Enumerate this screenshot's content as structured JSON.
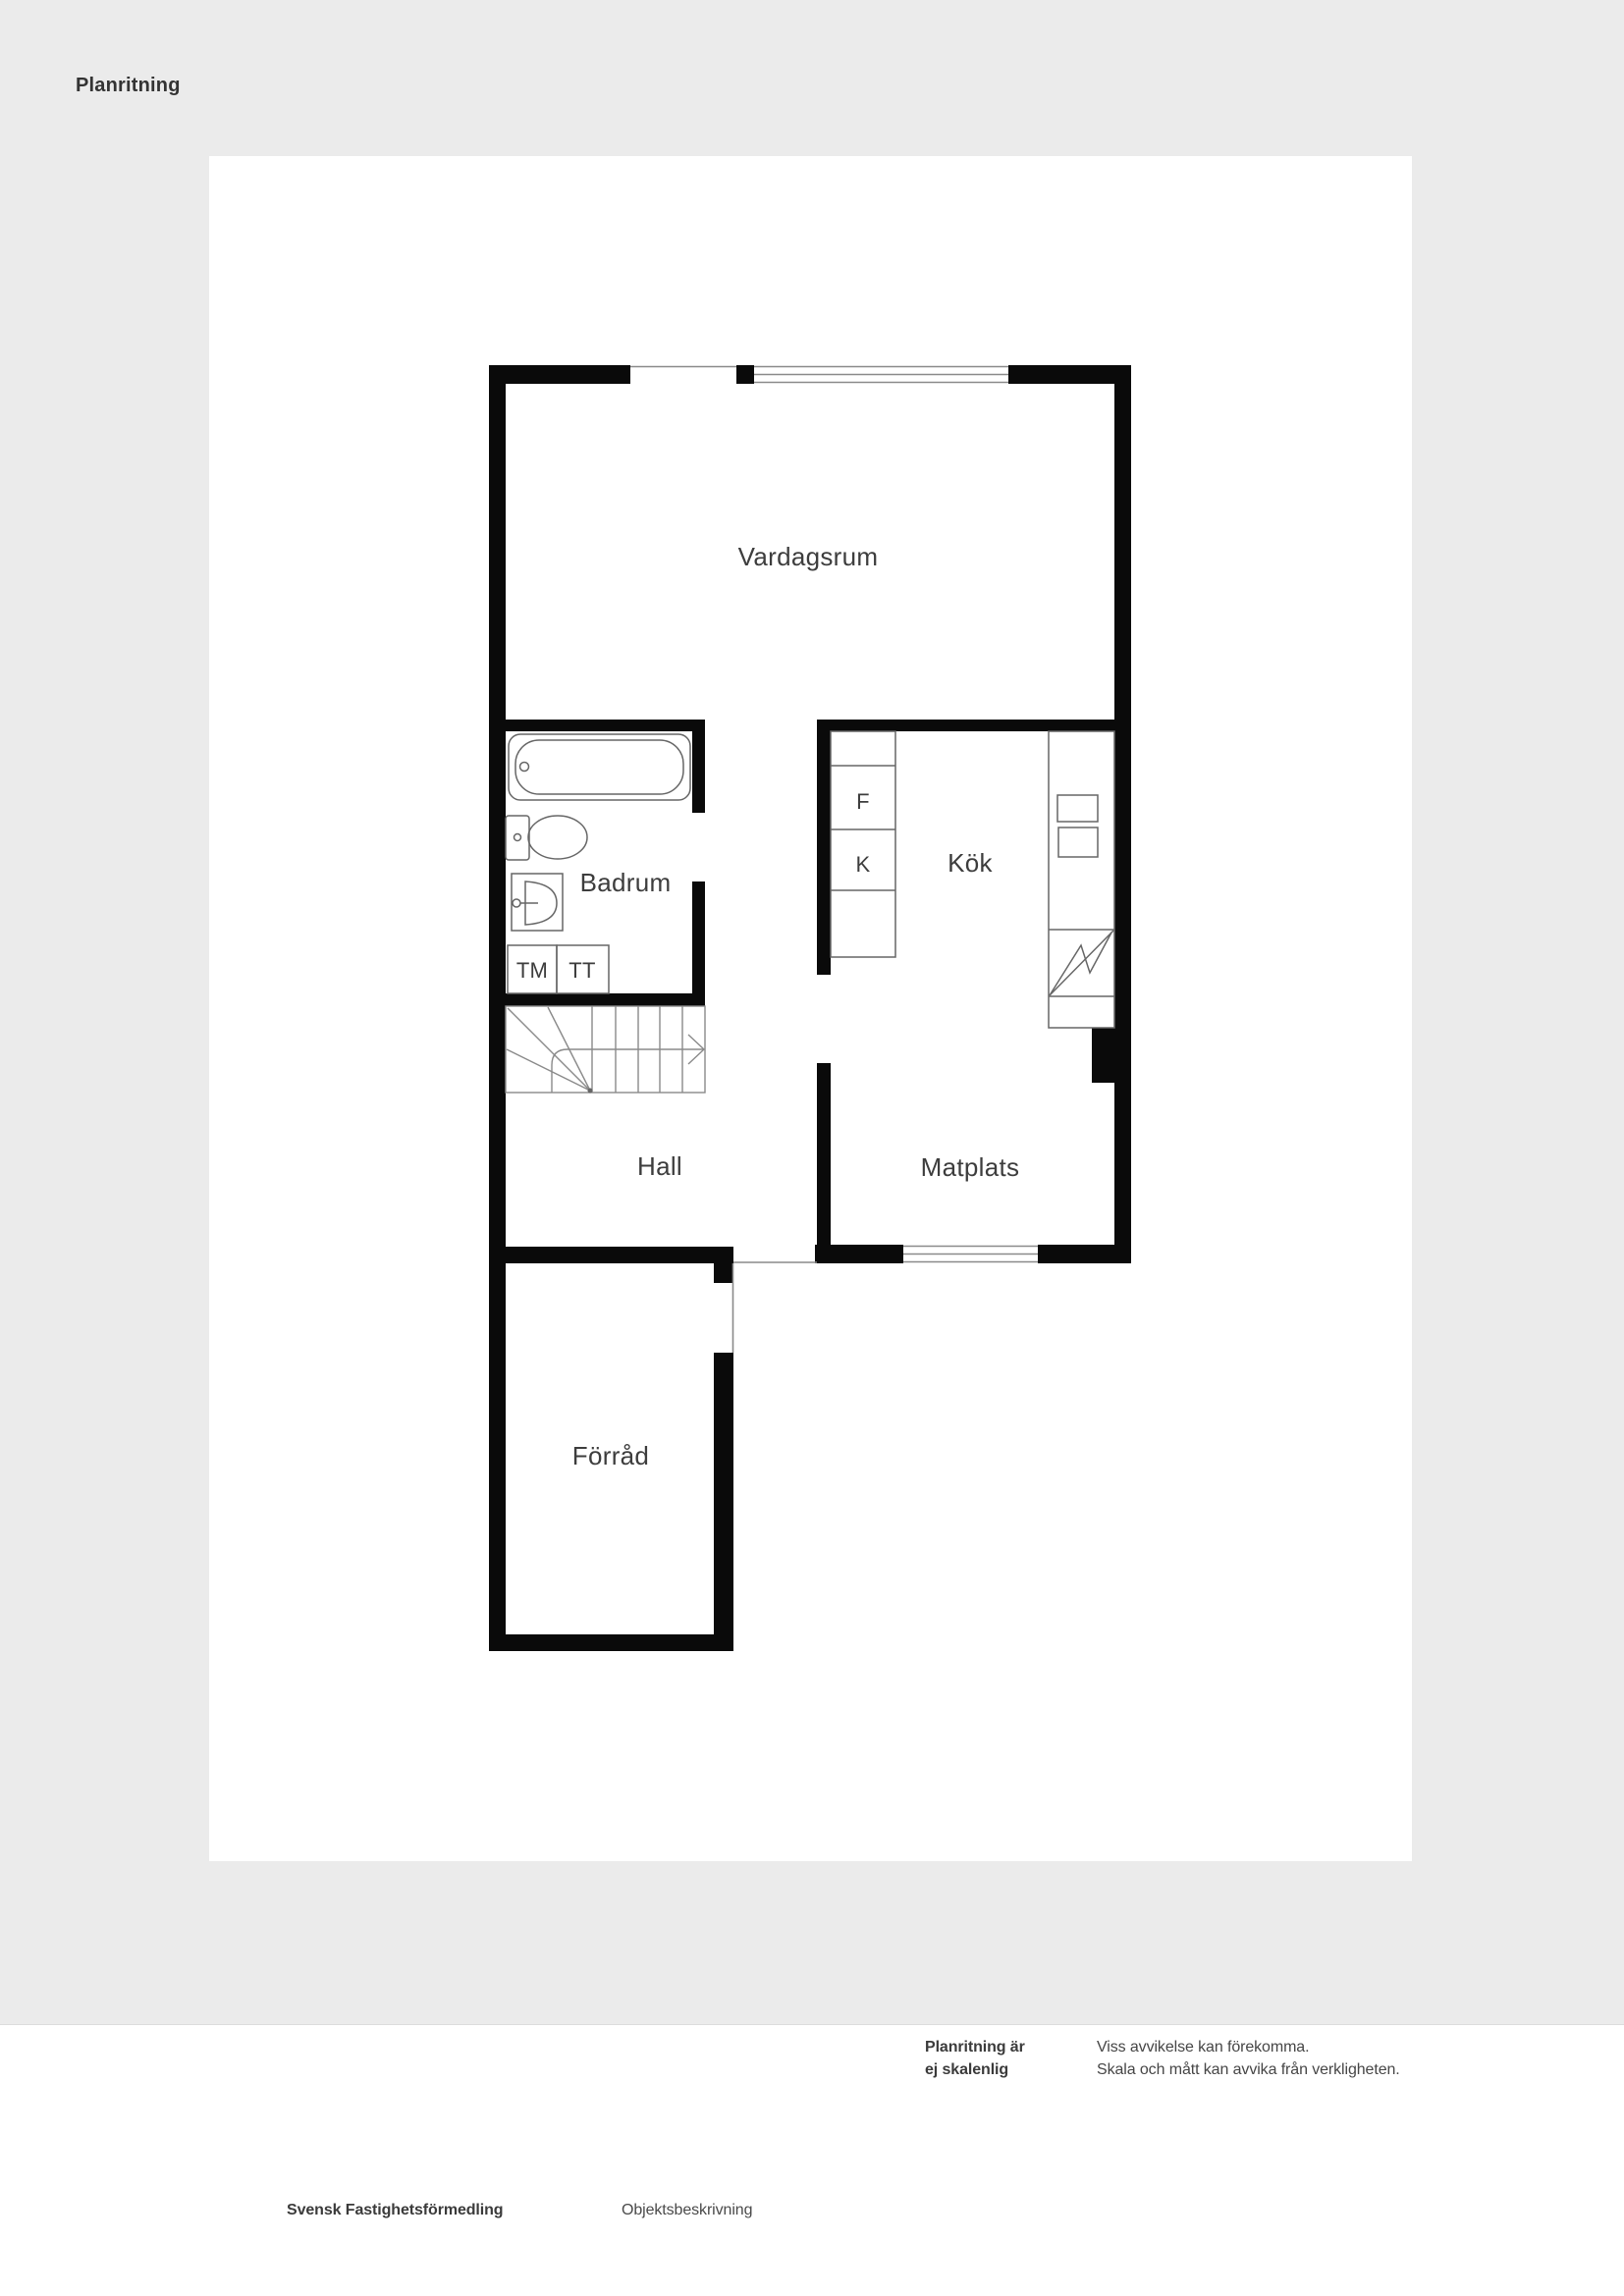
{
  "page": {
    "title": "Planritning"
  },
  "floorplan": {
    "rooms": {
      "living": "Vardagsrum",
      "bathroom": "Badrum",
      "kitchen": "Kök",
      "hall": "Hall",
      "dining": "Matplats",
      "storage": "Förråd"
    },
    "appliances": {
      "washing_machine": "TM",
      "tumble_dryer": "TT",
      "freezer": "F",
      "fridge": "K"
    }
  },
  "disclaimer": {
    "scale_note_line1": "Planritning är",
    "scale_note_line2": "ej skalenlig",
    "deviation_line1": "Viss avvikelse kan förekomma.",
    "deviation_line2": "Skala och mått kan avvika från verkligheten."
  },
  "footer": {
    "brand": "Svensk Fastighetsförmedling",
    "document": "Objektsbeskrivning"
  },
  "colors": {
    "page_bg": "#ebebeb",
    "plan_bg": "#ffffff",
    "wall": "#0a0a0a",
    "text": "#3d3d3d",
    "thin_line": "#8a8a8a"
  }
}
